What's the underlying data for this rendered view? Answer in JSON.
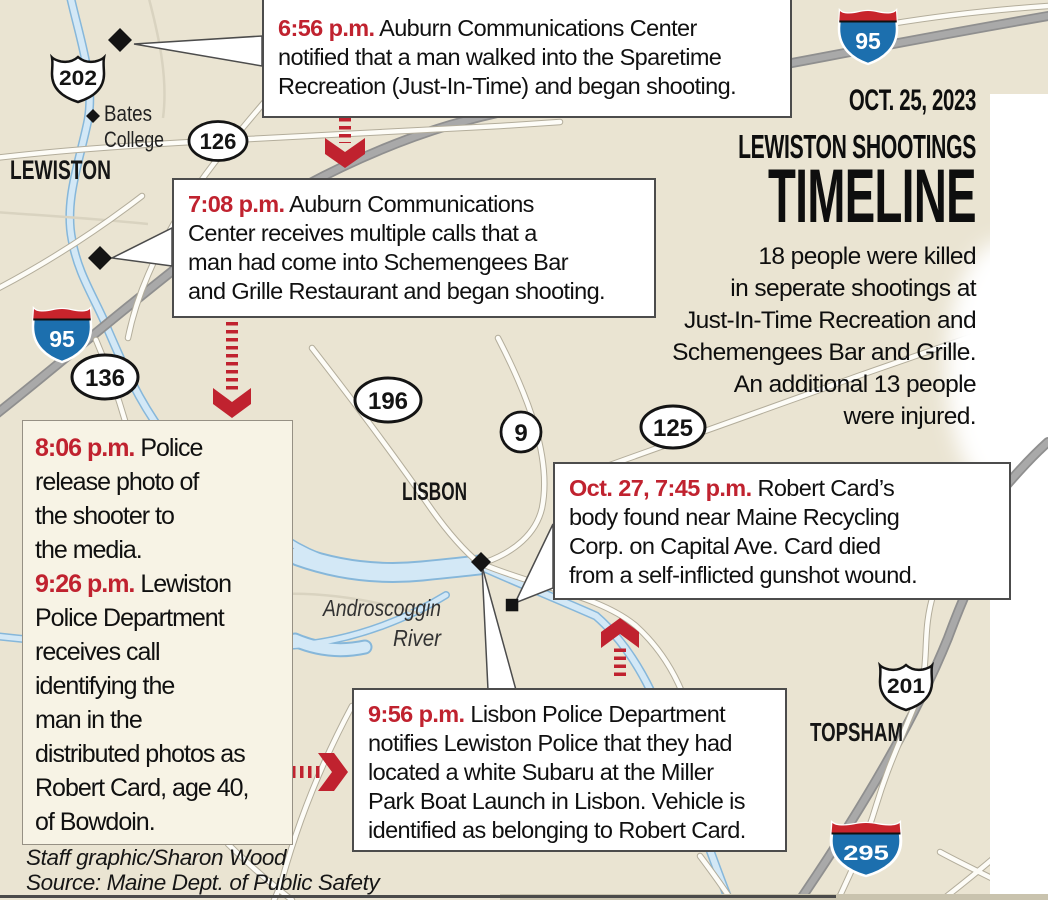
{
  "header": {
    "date": "OCT. 25, 2023",
    "kicker": "LEWISTON SHOOTINGS",
    "title": "TIMELINE",
    "summary_lines": [
      "18 people were killed",
      "in seperate shootings at",
      "Just-In-Time Recreation and",
      "Schemengees Bar and Grille.",
      "An additional 13 people",
      "were injured."
    ]
  },
  "callouts": [
    {
      "segments": [
        {
          "time": "6:56 p.m.",
          "text": "Auburn Communications Center\nnotified that a man walked into the Sparetime\nRecreation (Just-In-Time) and began shooting."
        }
      ]
    },
    {
      "segments": [
        {
          "time": "7:08 p.m.",
          "text": "Auburn Communications\nCenter receives multiple calls that a\nman had come into Schemengees Bar\nand Grille Restaurant and began shooting."
        }
      ]
    },
    {
      "segments": [
        {
          "time": "8:06 p.m.",
          "text": "Police\nrelease photo of\nthe shooter to\nthe media."
        },
        {
          "time": "9:26 p.m.",
          "text": "Lewiston\nPolice Department\nreceives call\nidentifying the\nman in the\ndistributed photos as\nRobert Card, age 40,\nof Bowdoin."
        }
      ]
    },
    {
      "segments": [
        {
          "time": "Oct. 27, 7:45 p.m.",
          "text": "Robert Card’s\nbody found near Maine Recycling\nCorp. on Capital Ave. Card died\nfrom a self-inflicted gunshot wound."
        }
      ]
    },
    {
      "segments": [
        {
          "time": "9:56 p.m.",
          "text": "Lisbon Police Department\nnotifies Lewiston Police that they had\nlocated a white Subaru at the Miller\nPark Boat Launch in Lisbon. Vehicle is\nidentified as belonging to Robert Card."
        }
      ]
    }
  ],
  "map": {
    "cities": {
      "lewiston": "LEWISTON",
      "lisbon": "LISBON",
      "topsham": "TOPSHAM"
    },
    "landmarks": {
      "bates_line1": "Bates",
      "bates_line2": "College",
      "river_line1": "Androscoggin",
      "river_line2": "River"
    },
    "shields": {
      "us202": "202",
      "rt126": "126",
      "i95": "95",
      "rt136": "136",
      "rt196": "196",
      "rt9": "9",
      "rt125": "125",
      "us201": "201",
      "i295": "295"
    }
  },
  "credits": {
    "byline": "Staff graphic/Sharon Wood",
    "source": "Source: Maine Dept. of Public Safety"
  },
  "colors": {
    "accent": "#c0222f",
    "map_bg": "#eae4d2",
    "river": "#d3e8f6",
    "river_edge": "#86b7da",
    "interstate_blue": "#1c6fae",
    "interstate_red": "#c8242c",
    "turnpike_gray": "#a9a9a9"
  }
}
